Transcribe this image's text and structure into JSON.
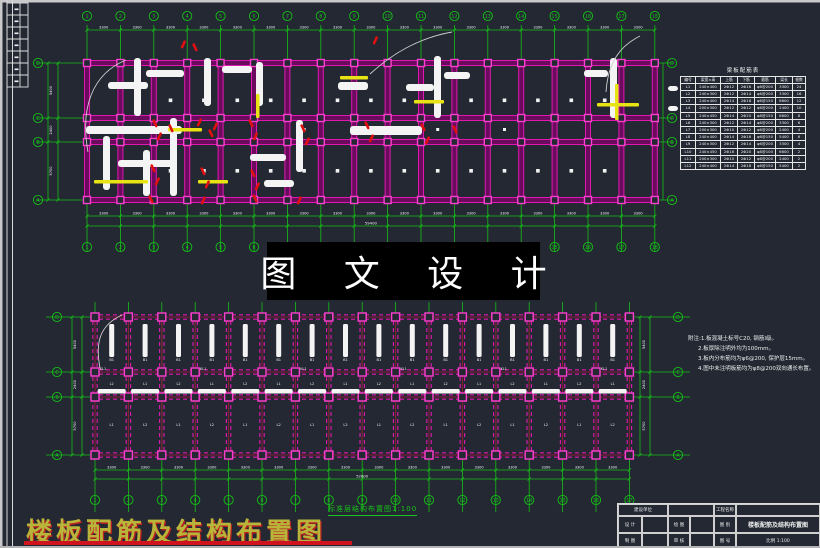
{
  "colors": {
    "background": "#232833",
    "green": "#16c016",
    "magenta": "#e018b0",
    "magenta_dark": "#6b0b5e",
    "magenta_light": "#ff3fd0",
    "crimson": "#b01345",
    "dark_red": "#8e1638",
    "yellow": "#e8e414",
    "white": "#f2f2f2",
    "red": "#e01010",
    "frame_gray": "#c9c9c9",
    "leader_gray": "#cfcfcf"
  },
  "watermark": {
    "text": "图 文 设 计"
  },
  "bottom_title": {
    "text": "楼板配筋及结构布置图"
  },
  "plan_top": {
    "axis_numbers": [
      "1",
      "2",
      "3",
      "4",
      "5",
      "6",
      "7",
      "8",
      "9",
      "10",
      "11",
      "12",
      "13",
      "14",
      "15",
      "16",
      "17",
      "18"
    ],
    "row_letters": [
      "D",
      "C",
      "B",
      "A"
    ],
    "bay_dim": "3300",
    "total_dim": "59400",
    "row_dims": [
      "5400",
      "2400",
      "5700"
    ]
  },
  "plan_bottom": {
    "caption": "标准层结构布置图1:100",
    "axis_numbers": [
      "1",
      "2",
      "3",
      "4",
      "5",
      "6",
      "7",
      "8",
      "9",
      "10",
      "11",
      "12",
      "13",
      "14",
      "15",
      "16",
      "17"
    ],
    "row_letters": [
      "D",
      "C",
      "B",
      "A"
    ],
    "bay_dim": "3300",
    "total_dim": "52800",
    "row_dims": [
      "5400",
      "2400",
      "5700"
    ],
    "bar_label": "B1",
    "beam_labels": [
      "L1",
      "L2"
    ],
    "column_label": "KL1"
  },
  "schedule": {
    "title": "梁板配筋表",
    "headers": [
      "编号",
      "梁宽×高",
      "上筋",
      "下筋",
      "箍筋",
      "梁长",
      "根数"
    ],
    "rows": [
      [
        "L1",
        "240×400",
        "2Φ12",
        "2Φ16",
        "φ6@200",
        "3300",
        "24"
      ],
      [
        "L2",
        "240×300",
        "2Φ12",
        "2Φ14",
        "φ6@200",
        "3300",
        "16"
      ],
      [
        "L3",
        "240×400",
        "2Φ14",
        "2Φ18",
        "φ6@150",
        "6600",
        "12"
      ],
      [
        "L4",
        "200×300",
        "2Φ12",
        "2Φ12",
        "φ6@200",
        "2400",
        "10"
      ],
      [
        "L5",
        "240×450",
        "2Φ14",
        "2Φ20",
        "φ8@150",
        "6600",
        "8"
      ],
      [
        "L6",
        "240×300",
        "2Φ12",
        "2Φ14",
        "φ6@200",
        "3300",
        "6"
      ],
      [
        "L7",
        "200×300",
        "2Φ10",
        "2Φ12",
        "φ6@200",
        "2400",
        "4"
      ],
      [
        "L8",
        "240×400",
        "2Φ14",
        "2Φ16",
        "φ6@150",
        "5400",
        "6"
      ],
      [
        "L9",
        "240×300",
        "2Φ12",
        "2Φ14",
        "φ6@200",
        "3300",
        "4"
      ],
      [
        "L10",
        "240×450",
        "2Φ16",
        "2Φ20",
        "φ8@100",
        "6600",
        "2"
      ],
      [
        "L11",
        "200×300",
        "2Φ10",
        "2Φ12",
        "φ6@200",
        "2400",
        "2"
      ],
      [
        "L12",
        "240×400",
        "2Φ14",
        "2Φ18",
        "φ6@150",
        "5400",
        "2"
      ]
    ]
  },
  "notes": {
    "lines": [
      "附注:1.板混凝土标号C20, 钢筋Ⅰ级。",
      "2.板厚除注明外均为100mm。",
      "3.板内分布筋均为φ6@200, 保护层15mm。",
      "4.图中未注明板筋均为φ8@200双向通长布置。"
    ]
  },
  "title_block": {
    "r1c1": "建设单位",
    "r1c5": "工程名称",
    "r2c1": "设 计",
    "r2c3": "绘 图",
    "r2c5": "图 别",
    "r2_main": "楼板配筋及结构布置图",
    "r3c1": "制 图",
    "r3c3": "审 核",
    "r3c5": "图 号",
    "r3_main": "比例 1:100"
  }
}
